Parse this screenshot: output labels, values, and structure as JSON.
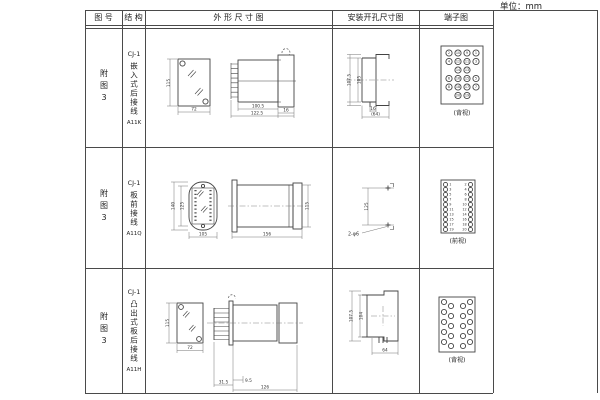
{
  "unit_label": "单位：mm",
  "header": {
    "fig_no": "图 号",
    "structure": "结 构",
    "outline": "外 形 尺 寸 图",
    "mounting": "安装开孔尺寸图",
    "terminal": "端子图"
  },
  "rows": [
    {
      "fig_no": "附图3",
      "model": "CJ-1",
      "structure": "嵌入式后接线",
      "code": "A11K",
      "outline": {
        "front_h": "115",
        "front_w": "72",
        "side_body_w": "100.5",
        "side_total_w": "122.5",
        "side_flange": "16"
      },
      "mounting": {
        "v1": "107.5",
        "v2": "105",
        "h1": "16",
        "h2": "(64)"
      },
      "terminal": {
        "caption": "(背视)",
        "grid": [
          [
            "2",
            "10",
            "9",
            "1"
          ],
          [
            "4",
            "12",
            "11",
            "3"
          ],
          [
            null,
            "14",
            "13",
            null
          ],
          [
            "6",
            "16",
            "15",
            "5"
          ],
          [
            "8",
            "18",
            "17",
            "7"
          ],
          [
            null,
            "20",
            "19",
            null
          ]
        ]
      }
    },
    {
      "fig_no": "附图3",
      "model": "CJ-1",
      "structure": "板前接线",
      "code": "A11Q",
      "outline": {
        "front_h1": "140",
        "front_h2": "125",
        "front_w": "105",
        "side_w": "156",
        "side_h": "115"
      },
      "mounting": {
        "v1": "125",
        "label": "2-φ6"
      },
      "terminal": {
        "caption": "(前视)",
        "left": [
          "1",
          "3",
          "5",
          "7",
          "9",
          "11",
          "13",
          "15",
          "17",
          "19"
        ],
        "right": [
          "2",
          "4",
          "6",
          "8",
          "10",
          "12",
          "14",
          "16",
          "18",
          "20"
        ]
      }
    },
    {
      "fig_no": "附图3",
      "model": "CJ-1",
      "structure": "凸出式板后接线",
      "code": "A11H",
      "outline": {
        "front_h": "115",
        "front_w": "72",
        "side_d1": "31.5",
        "side_d2": "9.5",
        "side_d3": "126"
      },
      "mounting": {
        "v1": "107.5",
        "v2": "104",
        "h1": "64"
      },
      "terminal": {
        "caption": "(背视)",
        "pin_count": 20,
        "arrangement": "staggered"
      }
    }
  ]
}
